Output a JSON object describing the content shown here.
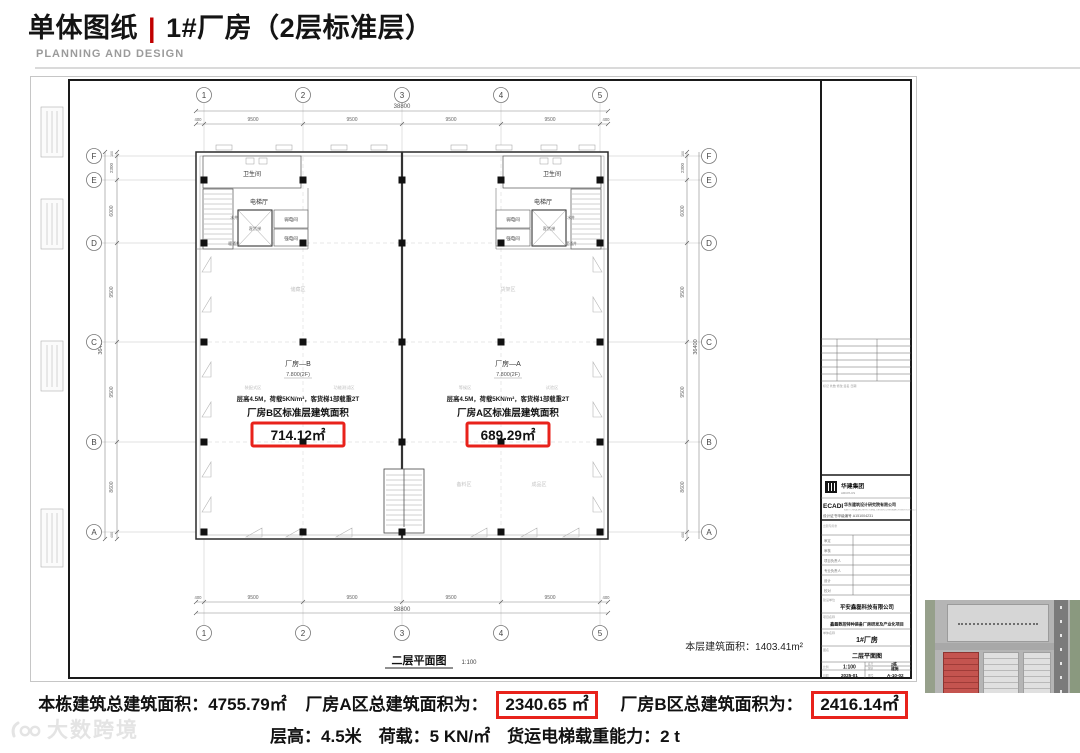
{
  "header": {
    "title_left": "单体图纸",
    "separator": "|",
    "title_right": "1#厂房（2层标准层）",
    "subtitle": "PLANNING AND DESIGN"
  },
  "plan": {
    "grid_cols": [
      "1",
      "2",
      "3",
      "4",
      "5"
    ],
    "grid_rows": [
      "F",
      "E",
      "D",
      "C",
      "B",
      "A"
    ],
    "dims_h": {
      "total": "38800",
      "segments": [
        "400",
        "9500",
        "9500",
        "9500",
        "9500",
        "400"
      ]
    },
    "dims_v": {
      "total": "36400",
      "segments": [
        "100",
        "2300",
        "6000",
        "9500",
        "9500",
        "8600",
        "400"
      ]
    },
    "core": {
      "toilet": "卫生间",
      "hall": "电梯厅",
      "lift": "客货梯",
      "weak": "弱电间",
      "strong": "强电间",
      "water": "水井",
      "hvac": "暖通井"
    },
    "zone_b": {
      "name": "厂房—B",
      "level": "7.800(2F)",
      "tag_left": "装配式区",
      "tag_right": "功能测试区",
      "spec": "层高4.5M，荷载5KN/m²，客货梯1部载重2T",
      "area_label": "厂房B区标准层建筑面积",
      "area_value": "714.12㎡"
    },
    "zone_a": {
      "name": "厂房—A",
      "level": "7.800(2F)",
      "tag_left": "等候区",
      "tag_right": "试验区",
      "spec": "层高4.5M，荷载5KN/m²，客货梯1部载重2T",
      "area_label": "厂房A区标准层建筑面积",
      "area_value": "689.29㎡"
    },
    "faint_rooms": [
      "储藏区",
      "货架区",
      "备料区",
      "成品区"
    ],
    "note": "本层建筑面积：1403.41m²",
    "caption": "二层平面图",
    "caption_scale": "1:100"
  },
  "titleblock": {
    "group_logo": "华建集团",
    "group_logo_sub": "ARCPLUS",
    "ecadi": "ECADI",
    "design_co": "华东建筑设计研究院有限公司",
    "design_co_en": "EAST CHINA ARCHITECTURAL DESIGN & RESEARCH INSTITUTE CO.,LTD.",
    "cert": "设计证书甲级编号 A151004231",
    "stamp_note": "出图专用章",
    "table_note": "标记  处数  修改  签名  日期",
    "rows": [
      "审定",
      "审核",
      "项目负责人",
      "专业负责人",
      "设计",
      "校对"
    ],
    "client_label": "建设单位",
    "client": "平安鑫磊科技有限公司",
    "project_label": "项目名称",
    "project": "鑫磊数控特种装备厂房研发及产业化项目",
    "building_label": "单体名称",
    "building": "1#厂房",
    "drawing_label": "图名",
    "drawing": "二层平面图",
    "scale_label": "比例",
    "scale": "1:100",
    "block_label": "栋号",
    "block": "2栋",
    "stage_label": "图别",
    "stage": "建施",
    "date_label": "日期",
    "date": "2025-01",
    "no_label": "图号",
    "no": "A-10-02"
  },
  "footer": {
    "line1_a": "本栋建筑总建筑面积：4755.79㎡",
    "line1_b": "厂房A区总建筑面积为：",
    "line1_b_val": "2340.65 ㎡",
    "line1_c": "厂房B区总建筑面积为：",
    "line1_c_val": "2416.14㎡",
    "line2": "层高：4.5米　荷载：5 KN/㎡　货运电梯载重能力：2 t"
  },
  "watermark": "大数跨境",
  "colors": {
    "accent_red": "#e8221b",
    "title_pipe": "#c00000"
  }
}
